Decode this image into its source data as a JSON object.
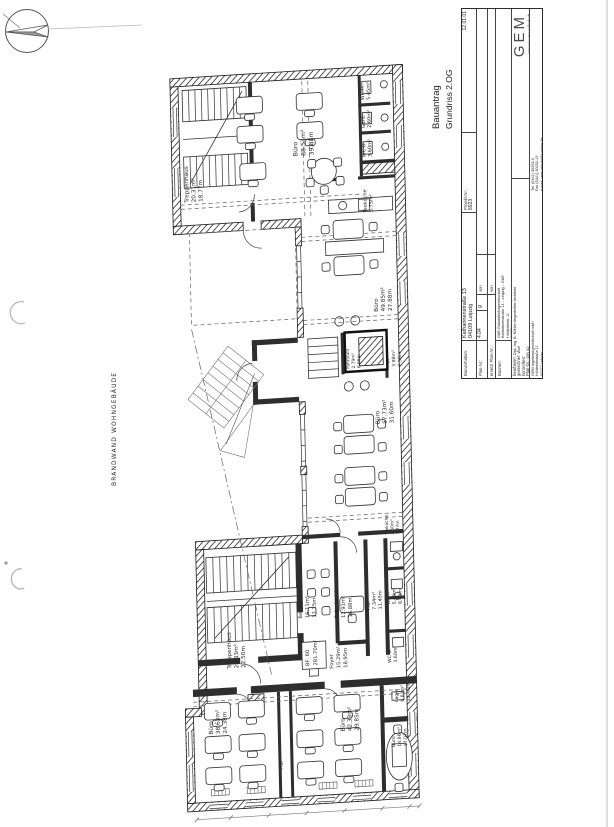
{
  "sheet": {
    "doc_type": "Bauantrag",
    "drawing_title": "Grundriss 2.OG",
    "boundary_note": "BRANDWAND WOHNGEBÄUDE",
    "icons": {
      "north_arrow": "compass-north-arrow"
    }
  },
  "title_block": {
    "bauvorhaben_label": "Bauvorhaben:",
    "bauvorhaben_line1": "Katharinenstraße 13",
    "bauvorhaben_line2": "04109 Leipzig",
    "projekt_label": "Projekt-Nr.:",
    "projekt_value": "8923",
    "date_value": "12.01.01",
    "plan_label": "Plan-Nr.:",
    "plan_value": "4.04",
    "plan_suffix": "g",
    "von_label": "von",
    "ersetzt_label": "ersetzt Plan-Nr.:",
    "ersetzt_von_label": "von",
    "bauherr_label": "Bauherr:",
    "bauherr_line1": "GbR Grundstücksgesellschaft",
    "bauherr_line2": "Katharinenstraße 13 – Leipzig – GbR",
    "bauherr_line3": "Hölderlinstr. 11",
    "bauherr_line4": "04277 Leipzig",
    "bearbeitet_label": "bearbeitet:",
    "bearbeitet_value": "Dipl.-Ing. B. Köhler",
    "bearbeitet_value2": "Angestellter Architekt",
    "gezeichnet_label": "gezeichnet:",
    "gezeichnet_value": "Wolf",
    "kontrolliert_label": "kontrolliert:",
    "kontrolliert_value": "",
    "plangr_label": "Plan-Gr.:",
    "plangr_value": "DIN A2",
    "logo_text": "GEM",
    "logo_subtext": "Ingenieurgesellschaft",
    "firm_line1": "GEM Ingenieurgesellschaft mbH",
    "firm_line2": "Hölderlinstraße 11",
    "firm_line3": "04277 Leipzig",
    "firm_line4": "Tel. (0341) 30252-0",
    "firm_line5": "Fax (0341) 30252-19",
    "firm_line6": "e-mail: gem-leipzig@t-online.de"
  },
  "plan": {
    "area_box": {
      "line1": "BF: 60",
      "line2": "281.70m²"
    },
    "rooms": [
      {
        "name": "Treppenhaus",
        "area": "20.31m²",
        "dim": "18.77m"
      },
      {
        "name": "Büro",
        "area": "88.53m²",
        "dim": "39.88m"
      },
      {
        "name": "WC-H",
        "area": "5.45m²",
        "dim": ""
      },
      {
        "name": "Gard.",
        "area": "2.60m²",
        "dim": ""
      },
      {
        "name": "WC-D",
        "area": "3.60m²",
        "dim": ""
      },
      {
        "name": "Teeküche",
        "area": "5.75m²",
        "dim": ""
      },
      {
        "name": "Büro",
        "area": "49.85m²",
        "dim": "27.88m"
      },
      {
        "name": "Fahrstuhl",
        "area": "2.79m²",
        "dim": "6.66m"
      },
      {
        "name": "Flur",
        "area": "3.98m²",
        "dim": "7.58m"
      },
      {
        "name": "Büro",
        "area": "57.73m²",
        "dim": "31.60m"
      },
      {
        "name": "Besprechung",
        "area": "16.11m²",
        "dim": "17.25m"
      },
      {
        "name": "Sekretariat",
        "area": "12.91m²",
        "dim": "16.88m"
      },
      {
        "name": "Flur",
        "area": "7.34m²",
        "dim": "11.45m"
      },
      {
        "name": "Teeküche",
        "area": "2.60m²",
        "dim": "3.77m"
      },
      {
        "name": "WC-H",
        "area": "5.43m²",
        "dim": "8.43m"
      },
      {
        "name": "WC-D",
        "area": "3.60m²",
        "dim": ""
      },
      {
        "name": "Foyer",
        "area": "15.29m²",
        "dim": "18.95m"
      },
      {
        "name": "Treppenhaus",
        "area": "28.33m²",
        "dim": "22.50m"
      },
      {
        "name": "Büro",
        "area": "38.63m²",
        "dim": "24.38m"
      },
      {
        "name": "Büro",
        "area": "42.33m²",
        "dim": "29.85m"
      },
      {
        "name": "Lager",
        "area": "6.81m²",
        "dim": "12.46m"
      },
      {
        "name": "Büro",
        "area": "14.96m²",
        "dim": "17.07m"
      },
      {
        "name": "Flur",
        "area": "",
        "dim": ""
      }
    ]
  }
}
